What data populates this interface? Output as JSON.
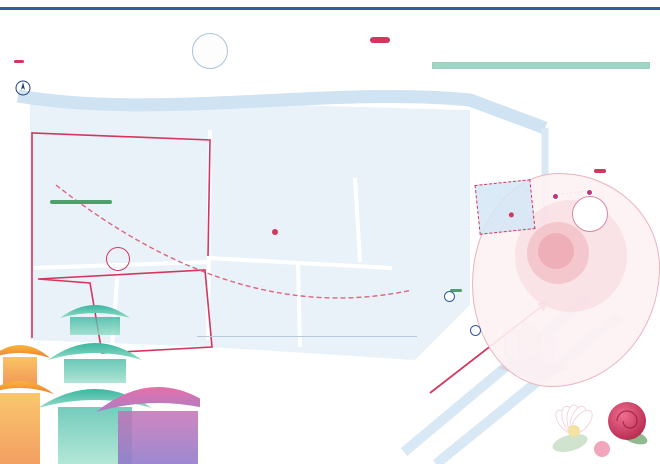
{
  "meta": {
    "brand": "SPRING LIMITED",
    "year": "2026"
  },
  "watermark": "Shanghai",
  "header": {
    "title": "2026上海国际花卉节地图",
    "badge": "古城公园主会场",
    "sub1": "The Map of Shanghai",
    "sub2": "International Flower Show",
    "compass": "N"
  },
  "logo": {
    "year": "2026",
    "en1": "Shanghai International",
    "en2": "Flower Show",
    "cn": "上海国际花卉节",
    "emblem": "❁"
  },
  "panel": {
    "title": "文商旅联动",
    "flower_strip": "✿ ✿ ✿ ✿ ✿ ✿ ✿ ✿ ✿ ✿ ✿ ✿ ✿ ✿",
    "market_title": "花卉集市",
    "paragraph": "花卉节期间将设置多处特色花卉集市，串联新天地、豫园商城、古城公园、BFC等地标，集合花卉绿植、文创手作、美食轻饮等丰富业态，营造春日赏花逛市新场景，等您前来打卡体验。",
    "legend": [
      {
        "type": "num",
        "num": "1",
        "label": "古城公园集市"
      },
      {
        "type": "num",
        "num": "2",
        "label": "豫园商城集市"
      },
      {
        "type": "num",
        "num": "3",
        "label": "BFC集市"
      },
      {
        "type": "num",
        "num": "4",
        "label": "演艺集市"
      },
      {
        "type": "num",
        "num": "5",
        "label": "亲子花集市"
      },
      {
        "type": "num",
        "num": "6",
        "label": "古城公园花市"
      },
      {
        "type": "num",
        "num": "7",
        "label": "滨江主题集市"
      },
      {
        "type": "num",
        "num": "8",
        "label": "Blendy 文创点位"
      },
      {
        "type": "diamond",
        "num": "",
        "label": "餐饮点位"
      },
      {
        "type": "plane",
        "num": "",
        "label": "打卡点位"
      }
    ]
  },
  "calendar": {
    "title": "古城公园演出Calendar",
    "days": [
      "一",
      "二",
      "三",
      "四",
      "五",
      "六",
      "日"
    ],
    "rows": [
      {
        "date": "4.26",
        "venue": "古城公园 15:00-16:00",
        "cells": [
          {
            "label": "精彩演出",
            "color": "yellow"
          },
          {
            "label": "精彩演出",
            "color": "teal"
          }
        ]
      },
      {
        "date": "5.3",
        "venue": "古城公园 15:00-16:00",
        "cells": [
          {
            "label": "精彩演出",
            "color": "yellow"
          },
          {
            "label": "精彩演出",
            "color": "teal"
          }
        ]
      },
      {
        "date": "5.10",
        "venue": "古城公园 15:00-16:00",
        "cells": [
          {
            "label": "精彩演出",
            "color": "pink"
          },
          {
            "label": "精彩演出",
            "color": "pink"
          },
          {
            "label": "精彩演出",
            "color": "yellow"
          }
        ]
      },
      {
        "date": "5.17",
        "venue": "古城公园 15:00-16:00",
        "cells": [
          {
            "label": "精彩演出",
            "color": "yellow"
          },
          {
            "label": "精彩演出",
            "color": "teal"
          }
        ]
      }
    ],
    "flower_strip": "✿ ✿ ✿ ✿ ✿ ✿ ✿ ✿ ✿ ✿ ✿ ✿ ✿ ✿ ✿ ✿ ✿ ✿"
  },
  "map": {
    "street_renmin": "人民路",
    "tunnel": "人民路隧道",
    "street_anren": "安仁街",
    "street_fuyou": "福佑路",
    "street_jiuxiaochang": "旧校场路",
    "street_fangbang": "方浜中路",
    "street_xinkaihe": "新开河路",
    "street_zhongshan": "中山东二路",
    "park_cn": "上海古城公园",
    "park_en": "Shanghai Gucheng Park",
    "yuyuan_cn": "豫园",
    "yuyuan_en": "Yu Garden",
    "gallery_line1": "古城艺术馆",
    "gallery_line2": "西门",
    "callout_num": "1",
    "callout": "古城公园集市",
    "metro": "M",
    "mini_badge": "辐射型图",
    "mini": {
      "park": "古城公园",
      "yu": "豫园",
      "block": "豫园商城",
      "chips": [
        {
          "label": "豫园站",
          "x": 500,
          "y": 253
        },
        {
          "label": "新天地",
          "x": 516,
          "y": 272
        },
        {
          "label": "城隍庙",
          "x": 560,
          "y": 262
        }
      ]
    },
    "bfc_pill": "BFC主题花园",
    "bfc_parking": "Ⓟ BFC停车",
    "bfc_cn": "BFC金融中心",
    "bfc_en": "BFC Financial Center",
    "markers": [
      {
        "letter": "A",
        "label": "半坡拾光",
        "x": 196,
        "y": 160
      },
      {
        "letter": "B",
        "label": "滨江风物",
        "x": 226,
        "y": 174
      },
      {
        "letter": "C",
        "label": "自在园",
        "x": 256,
        "y": 177
      },
      {
        "letter": "D",
        "label": "迷雾森林",
        "x": 152,
        "y": 148
      },
      {
        "letter": "E",
        "label": "古树之境",
        "x": 221,
        "y": 190
      },
      {
        "letter": "F",
        "label": "海上之声",
        "x": 286,
        "y": 177
      },
      {
        "letter": "G",
        "label": "花苑项链",
        "x": 215,
        "y": 204
      },
      {
        "letter": "H",
        "label": "禾",
        "x": 283,
        "y": 205
      },
      {
        "letter": "I",
        "label": "SITA幻境视觉秀",
        "x": 307,
        "y": 189
      },
      {
        "letter": "J",
        "label": "新住户",
        "x": 130,
        "y": 289
      },
      {
        "letter": "K",
        "label": "桥畔花瀑",
        "x": 330,
        "y": 287
      },
      {
        "letter": "L",
        "label": "一时春",
        "x": 117,
        "y": 258
      },
      {
        "letter": "M",
        "label": "心湖·花园",
        "x": 362,
        "y": 237
      }
    ],
    "photos": [
      {
        "x": 168,
        "y": 127,
        "r": 30,
        "tone": "trees"
      },
      {
        "x": 257,
        "y": 101,
        "r": 36,
        "tone": "trees2"
      },
      {
        "x": 313,
        "y": 108,
        "r": 28,
        "tone": "trees"
      },
      {
        "x": 352,
        "y": 131,
        "r": 25,
        "tone": "flowers"
      },
      {
        "x": 398,
        "y": 126,
        "r": 27,
        "tone": "pavilion"
      },
      {
        "x": 300,
        "y": 281,
        "r": 33,
        "tone": "coral"
      },
      {
        "x": 358,
        "y": 256,
        "r": 27,
        "tone": "flowers"
      },
      {
        "x": 443,
        "y": 309,
        "r": 43,
        "tone": "field"
      },
      {
        "x": 495,
        "y": 344,
        "r": 31,
        "tone": "purple"
      },
      {
        "x": 128,
        "y": 299,
        "r": 26,
        "tone": "pavilion"
      },
      {
        "x": 231,
        "y": 299,
        "r": 32,
        "tone": "trees2"
      },
      {
        "x": 333,
        "y": 297,
        "r": 25,
        "tone": "gray"
      }
    ]
  },
  "venue": {
    "heading": "上海古城公园主会场",
    "columns": [
      [
        {
          "letter": "A",
          "name": "半坡拾光",
          "desc": "坡地光影花境 · 公园东北角 全天开放"
        },
        {
          "letter": "D",
          "name": "迷雾森林",
          "desc": "雾森互动体验 · 古树林区域 10:00-17:00"
        },
        {
          "letter": "G",
          "name": "花苑项链",
          "desc": "环形花带景观 · 园内主环路沿线"
        },
        {
          "letter": "J",
          "name": "新住户",
          "desc": "城市生态装置 · 公园西入口广场"
        },
        {
          "letter": "M",
          "name": "心湖·花园",
          "desc": "湖畔花园景观 · 心湖沿岸步道"
        }
      ],
      [
        {
          "letter": "B",
          "name": "滨江风物",
          "desc": "滨水花园景观 · 人民路沿线绿地"
        },
        {
          "letter": "E",
          "name": "古树之境·绿岛寻踪",
          "desc": "古树名木展示 · 生态绿岛区域"
        },
        {
          "letter": "H",
          "name": "禾",
          "desc": "稻禾主题装置 · 东侧阳光草坪"
        },
        {
          "letter": "K",
          "name": "桥畔花瀑",
          "desc": "立体花瀑景观 · 景观桥畔"
        }
      ],
      [
        {
          "letter": "C",
          "name": "自在园",
          "desc": "自然疗愈花园 · 公园中心草坪"
        },
        {
          "letter": "F",
          "name": "海上之声",
          "desc": "海派主题花艺 · 中心舞台旁"
        },
        {
          "letter": "I",
          "name": "SITA幻境视觉秀",
          "desc": "夜间光影视觉秀 · 每晚准时呈现"
        },
        {
          "letter": "L",
          "name": "一时春",
          "desc": "春日主题花展 · 西南门区域"
        }
      ]
    ]
  },
  "footer": {
    "cn": "黄浦城市主会场",
    "en": "Huangpu City Main Venue"
  }
}
